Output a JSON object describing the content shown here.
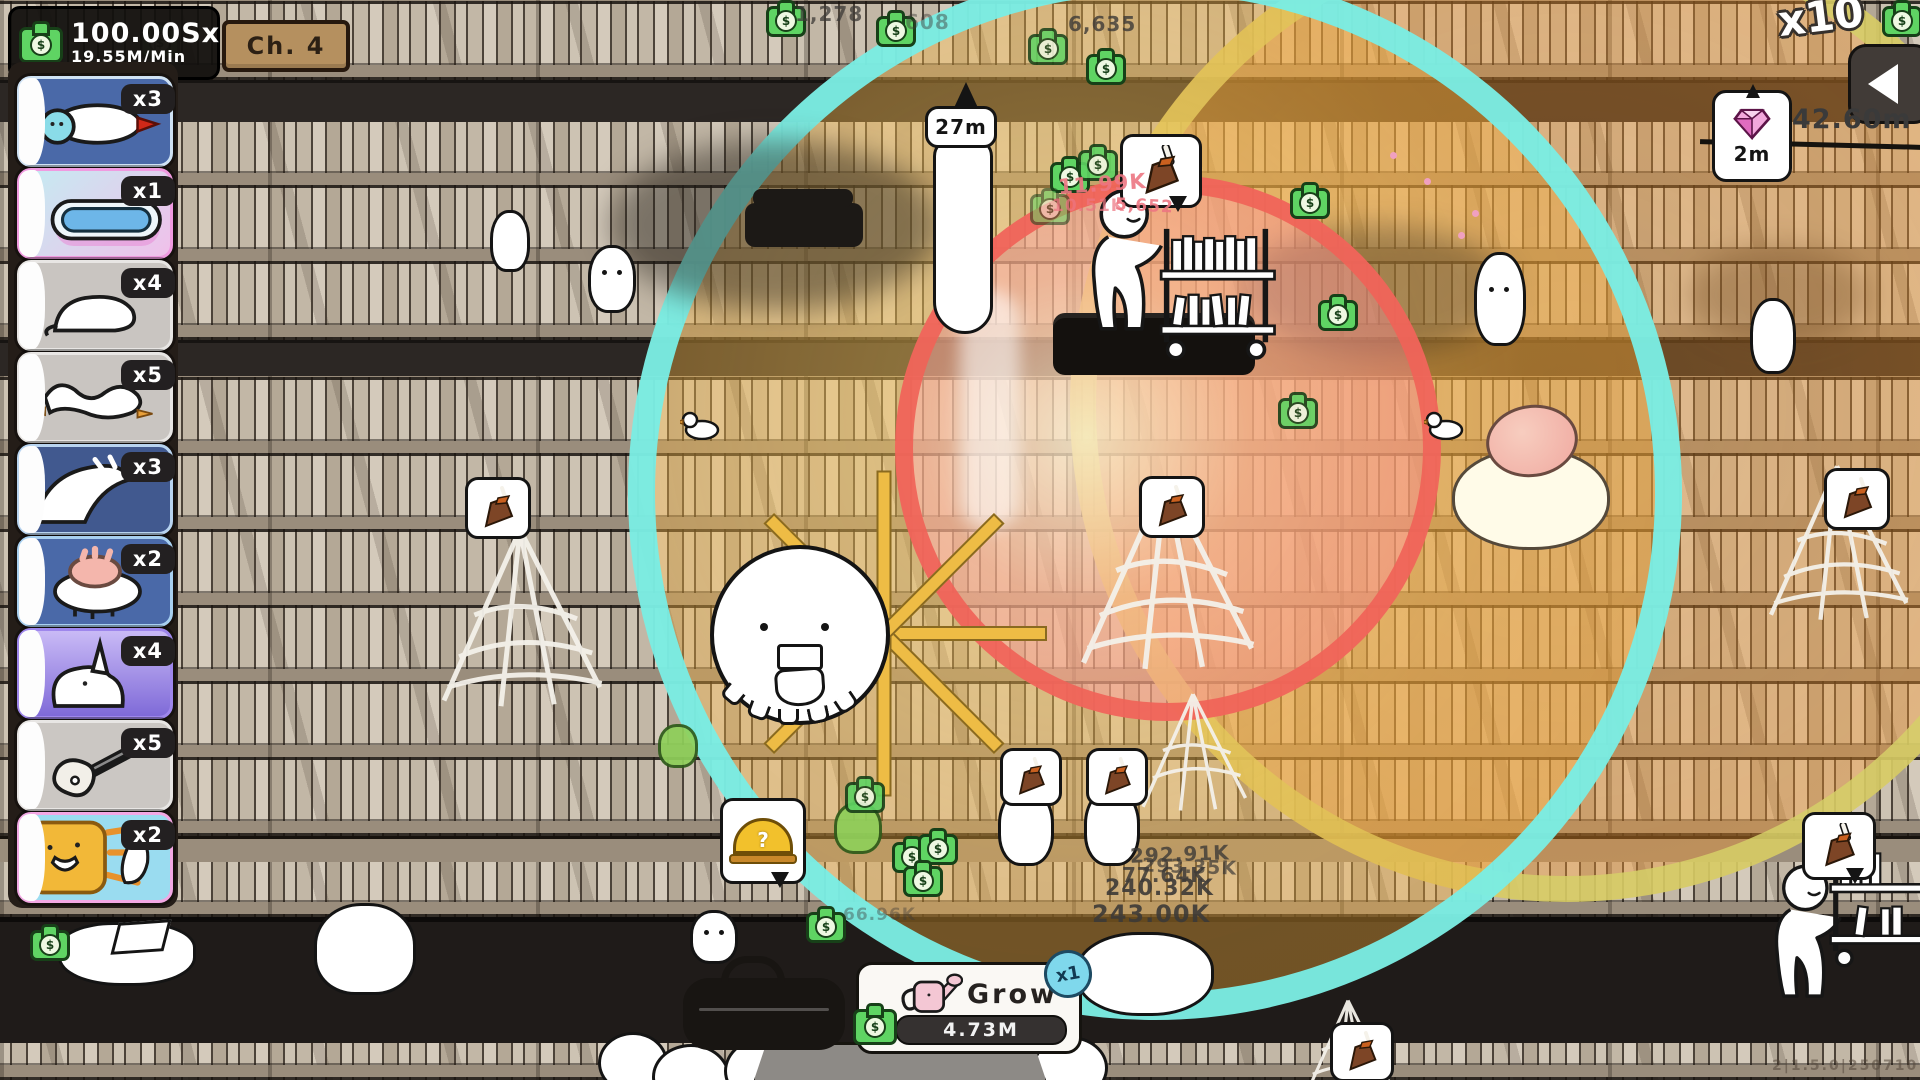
{
  "hud": {
    "money": {
      "amount": "100.00Sx",
      "rate": "19.55M/Min"
    },
    "chapter_sign": "Ch. 4",
    "top_right_multiplier": "x10",
    "distance_label": "42.60m",
    "gem_timer": "2m",
    "broom_timer": "27m"
  },
  "sidebar": {
    "cards": [
      {
        "id": "caterpillar",
        "multiplier": "x3"
      },
      {
        "id": "pool",
        "multiplier": "x1"
      },
      {
        "id": "bowing-goose",
        "multiplier": "x4"
      },
      {
        "id": "tangled-geese",
        "multiplier": "x5"
      },
      {
        "id": "diving-goose",
        "multiplier": "x3"
      },
      {
        "id": "sheep",
        "multiplier": "x2"
      },
      {
        "id": "rhino",
        "multiplier": "x4"
      },
      {
        "id": "guitar",
        "multiplier": "x5"
      },
      {
        "id": "sun",
        "multiplier": "x2"
      }
    ]
  },
  "grow": {
    "label": "Grow",
    "cost": "4.73M",
    "stack_badge": "x1"
  },
  "floating": {
    "red": [
      "11.99K",
      "10.51K",
      "5,652"
    ],
    "dark": [
      "1,278",
      "608",
      "6,635",
      "292.91K",
      "293.35K",
      "77.64K",
      "240.32K",
      "243.00K",
      "66.96K"
    ]
  },
  "icons": {
    "dollar": "$",
    "question": "?"
  },
  "version": "2|1.5.0|250710",
  "colors": {
    "cyan_ring": "#7deee8",
    "red_ring": "#f0635c",
    "olive_ring": "#d6d06b",
    "money_green": "#5ed05e",
    "accent_pink": "#f09ae0"
  }
}
